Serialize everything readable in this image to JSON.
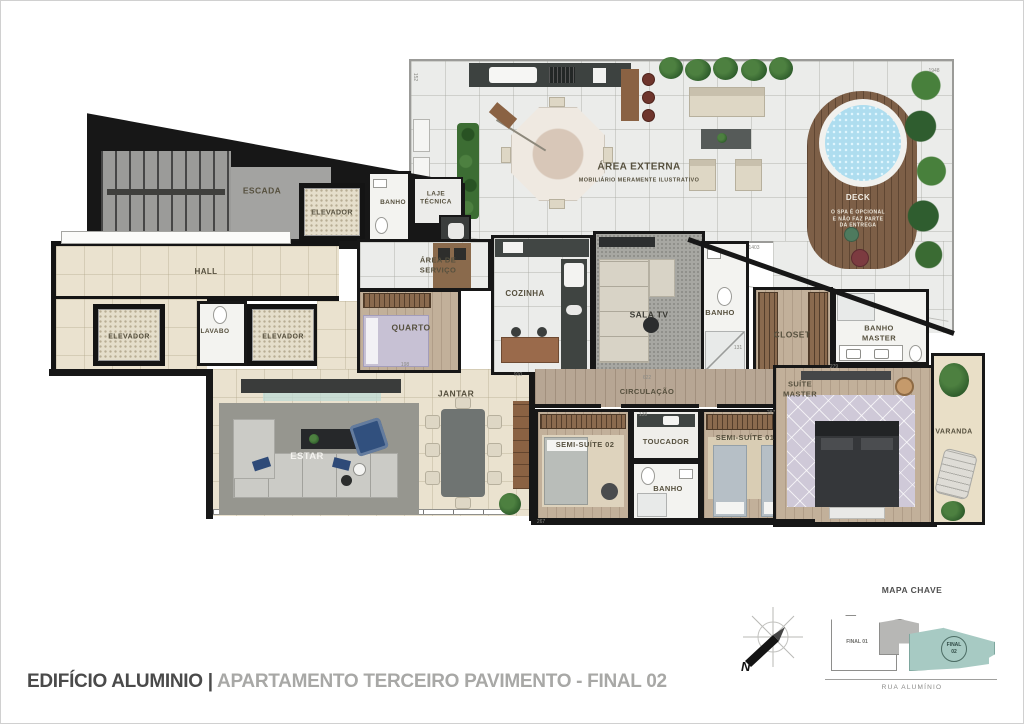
{
  "title": {
    "building": "EDIFÍCIO ALUMINIO",
    "separator": "|",
    "unit": "APARTAMENTO TERCEIRO PAVIMENTO - FINAL 02"
  },
  "compass": {
    "north_label": "N"
  },
  "key_map": {
    "title": "MAPA CHAVE",
    "street": "RUA ALUMÍNIO",
    "final_01": "FINAL 01",
    "final_02": "FINAL 02",
    "highlight_color": "#a7cac3"
  },
  "plan": {
    "rooms": [
      {
        "id": "escada",
        "lines": [
          "ESCADA"
        ],
        "x": 261,
        "y": 190,
        "fs": 8.5
      },
      {
        "id": "elevador-1",
        "lines": [
          "ELEVADOR"
        ],
        "x": 331,
        "y": 212,
        "fs": 7
      },
      {
        "id": "banho-1",
        "lines": [
          "BANHO"
        ],
        "x": 392,
        "y": 202,
        "fs": 6.5
      },
      {
        "id": "laje-tecnica",
        "lines": [
          "LAJE",
          "TÉCNICA"
        ],
        "x": 435,
        "y": 198,
        "fs": 6.5
      },
      {
        "id": "area-externa",
        "lines": [
          "ÁREA EXTERNA"
        ],
        "x": 638,
        "y": 166,
        "fs": 10
      },
      {
        "id": "area-externa-note",
        "lines": [
          "MOBILIÁRIO MERAMENTE ILUSTRATIVO"
        ],
        "x": 638,
        "y": 180,
        "fs": 5.5
      },
      {
        "id": "deck",
        "lines": [
          "DECK"
        ],
        "x": 857,
        "y": 197,
        "fs": 8,
        "c": "#f2eee5"
      },
      {
        "id": "deck-note",
        "lines": [
          "O SPA É OPCIONAL",
          "E NÃO FAZ PARTE",
          "DA ENTREGA"
        ],
        "x": 857,
        "y": 218,
        "fs": 5,
        "c": "#ece7db"
      },
      {
        "id": "hall",
        "lines": [
          "HALL"
        ],
        "x": 205,
        "y": 271,
        "fs": 8
      },
      {
        "id": "elevador-2",
        "lines": [
          "ELEVADOR"
        ],
        "x": 128,
        "y": 336,
        "fs": 7
      },
      {
        "id": "lavabo",
        "lines": [
          "LAVABO"
        ],
        "x": 214,
        "y": 331,
        "fs": 6.5
      },
      {
        "id": "elevador-3",
        "lines": [
          "ELEVADOR"
        ],
        "x": 282,
        "y": 336,
        "fs": 7
      },
      {
        "id": "area-servico",
        "lines": [
          "ÁREA DE",
          "SERVIÇO"
        ],
        "x": 437,
        "y": 264,
        "fs": 7.5
      },
      {
        "id": "quarto",
        "lines": [
          "QUARTO"
        ],
        "x": 410,
        "y": 327,
        "fs": 8.5
      },
      {
        "id": "cozinha",
        "lines": [
          "COZINHA"
        ],
        "x": 524,
        "y": 293,
        "fs": 8
      },
      {
        "id": "sala-tv",
        "lines": [
          "SALA TV"
        ],
        "x": 648,
        "y": 314,
        "fs": 8.5,
        "c": "#3b3b35"
      },
      {
        "id": "banho-2",
        "lines": [
          "BANHO"
        ],
        "x": 719,
        "y": 312,
        "fs": 7.5
      },
      {
        "id": "closet",
        "lines": [
          "CLOSET"
        ],
        "x": 791,
        "y": 334,
        "fs": 8.5
      },
      {
        "id": "banho-master",
        "lines": [
          "BANHO",
          "MASTER"
        ],
        "x": 878,
        "y": 332,
        "fs": 7.5
      },
      {
        "id": "suite-master",
        "lines": [
          "SUÍTE",
          "MASTER"
        ],
        "x": 799,
        "y": 388,
        "fs": 7.5
      },
      {
        "id": "circulacao",
        "lines": [
          "CIRCULAÇÃO"
        ],
        "x": 646,
        "y": 391,
        "fs": 7.5
      },
      {
        "id": "jantar",
        "lines": [
          "JANTAR"
        ],
        "x": 455,
        "y": 393,
        "fs": 8.5
      },
      {
        "id": "estar",
        "lines": [
          "ESTAR"
        ],
        "x": 306,
        "y": 456,
        "fs": 9.5,
        "c": "#f4f3ef"
      },
      {
        "id": "semi-suite-02",
        "lines": [
          "SEMI-SUÍTE 02"
        ],
        "x": 584,
        "y": 444,
        "fs": 7.5
      },
      {
        "id": "toucador",
        "lines": [
          "TOUCADOR"
        ],
        "x": 665,
        "y": 441,
        "fs": 7.5
      },
      {
        "id": "banho-3",
        "lines": [
          "BANHO"
        ],
        "x": 667,
        "y": 488,
        "fs": 7.5
      },
      {
        "id": "semi-suite-01",
        "lines": [
          "SEMI-SUÍTE 01"
        ],
        "x": 744,
        "y": 437,
        "fs": 7.5
      },
      {
        "id": "varanda",
        "lines": [
          "VARANDA"
        ],
        "x": 953,
        "y": 431,
        "fs": 7
      }
    ],
    "dimensions": [
      {
        "t": "1948",
        "x": 933,
        "y": 70
      },
      {
        "t": "152",
        "x": 414,
        "y": 76,
        "rot": 90
      },
      {
        "t": "1403",
        "x": 753,
        "y": 247
      },
      {
        "t": "622",
        "x": 646,
        "y": 377
      },
      {
        "t": "910",
        "x": 517,
        "y": 374
      },
      {
        "t": "138",
        "x": 642,
        "y": 414
      },
      {
        "t": "131",
        "x": 737,
        "y": 347
      },
      {
        "t": "198",
        "x": 404,
        "y": 364
      },
      {
        "t": "279",
        "x": 833,
        "y": 366
      },
      {
        "t": "287",
        "x": 770,
        "y": 412
      },
      {
        "t": "267",
        "x": 540,
        "y": 521
      }
    ]
  }
}
